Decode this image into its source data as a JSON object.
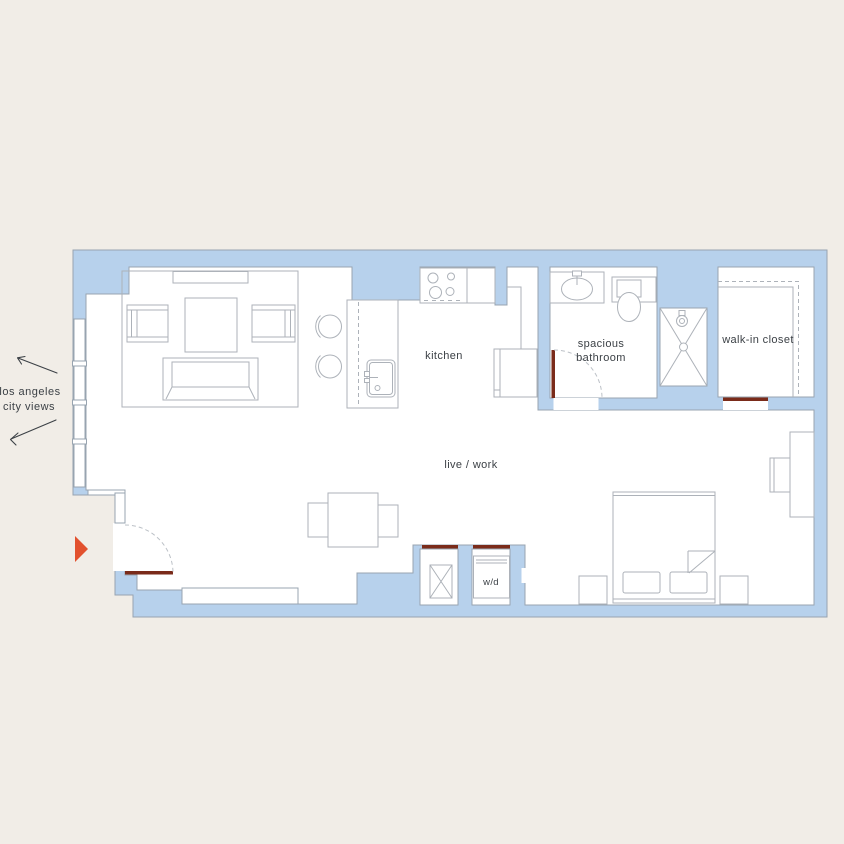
{
  "palette": {
    "background": "#f1ede7",
    "floorFill": "#ffffff",
    "wallFill": "#b7d1ec",
    "wallLine": "#98a4b0",
    "furnLine": "#adb2b9",
    "arcLine": "#bcc1c7",
    "textColor": "#3c4146",
    "thresholdColor": "#7a2b1a",
    "markerColor": "#e2512e"
  },
  "labels": {
    "kitchen": "kitchen",
    "bathroom_line1": "spacious",
    "bathroom_line2": "bathroom",
    "closet": "walk-in closet",
    "living": "live / work",
    "laundry": "w/d",
    "view_line1": "los angeles",
    "view_line2": "city views"
  },
  "icons": {
    "entry_marker": "right-pointing-triangle",
    "view_arrows": [
      "arrow-up-left",
      "arrow-down-left"
    ]
  }
}
